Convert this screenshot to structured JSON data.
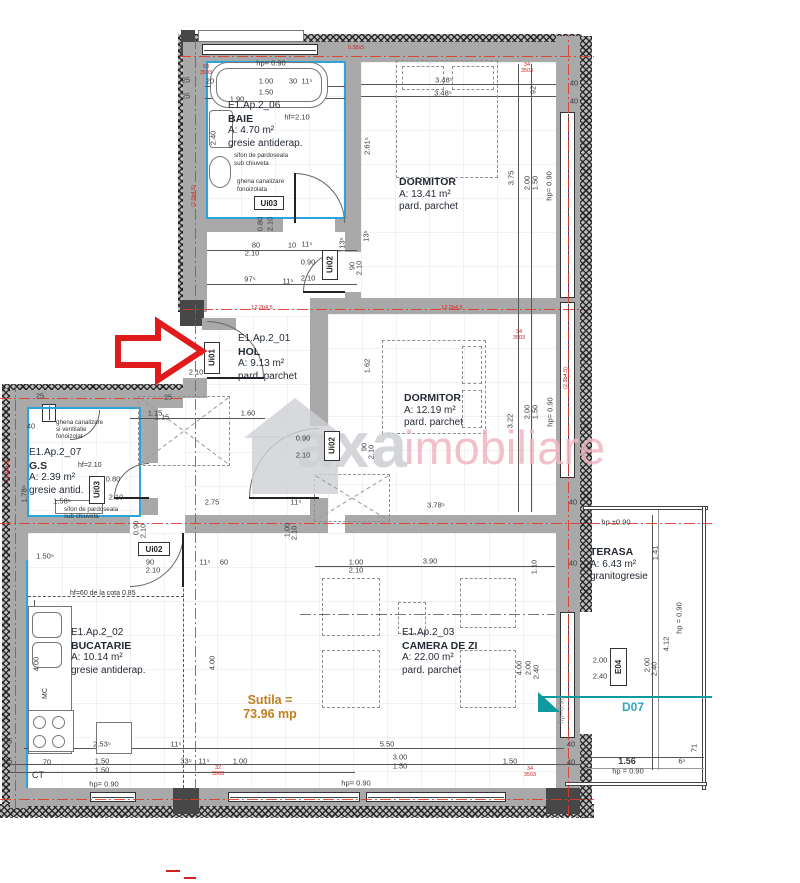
{
  "watermark": {
    "brand_gray": "axa",
    "brand_pink": "imobiliare"
  },
  "colors": {
    "axis_red": "#e03a2a",
    "arrow_red": "#e01b1b",
    "teal": "#0f9aa0",
    "total_orange": "#c07f1f",
    "waterproof_blue": "#2ba3dc",
    "wall_gray": "#a9a9a9"
  },
  "rooms": {
    "baie": {
      "code": "E1.Ap.2_06",
      "name": "BAIE",
      "area": "A: 4.70 m²",
      "floor": "gresie antiderap.",
      "note1": "sifon de pardoseala",
      "note2": "sub chiuveta",
      "note3": "ghena canalizare",
      "note4": "fonoizolata"
    },
    "dormitor1": {
      "name": "DORMITOR",
      "area": "A: 13.41 m²",
      "floor": "pard. parchet"
    },
    "hol": {
      "code": "E1.Ap.2_01",
      "name": "HOL",
      "area": "A: 9.13 m²",
      "floor": "pard. parchet"
    },
    "dormitor2": {
      "name": "DORMITOR",
      "area": "A: 12.19 m²",
      "floor": "pard. parchet"
    },
    "gs": {
      "code": "E1.Ap.2_07",
      "name": "G.S",
      "area": "A: 2.39 m²",
      "floor": "gresie antid.",
      "note1": "ghena canalizare",
      "note2": "si ventilatie",
      "note3": "fonoizolat",
      "note4": "sifon de pardoseala",
      "note5": "sub chiuveta"
    },
    "bucatarie": {
      "code": "E1.Ap.2_02",
      "name": "BUCATARIE",
      "area": "A: 10.14 m²",
      "floor": "gresie antiderap.",
      "note1": "hf=60 de la cota 0.85",
      "mc": "MC",
      "ct": "CT"
    },
    "camera_de_zi": {
      "code": "E1.Ap.2_03",
      "name": "CAMERA DE ZI",
      "area": "A: 22.00 m²",
      "floor": "pard. parchet"
    },
    "terasa": {
      "name": "TERASA",
      "area": "A: 6.43 m²",
      "floor": "granitogresie"
    }
  },
  "total": {
    "label": "Sutila =",
    "value": "73.96 mp"
  },
  "door_labels": {
    "ui01": "Ui01",
    "ui02": "Ui02",
    "ui03": "Ui03",
    "e04": "E04",
    "d07": "D07"
  },
  "dimensions": [
    {
      "t": "hp= 0.90",
      "x": 271,
      "y": 63
    },
    {
      "t": "1.00",
      "x": 266,
      "y": 81
    },
    {
      "t": "1.50",
      "x": 266,
      "y": 92
    },
    {
      "t": "1.90",
      "x": 237,
      "y": 99
    },
    {
      "t": "30",
      "x": 293,
      "y": 81
    },
    {
      "t": "11⁵",
      "x": 307,
      "y": 81
    },
    {
      "t": "20",
      "x": 210,
      "y": 81
    },
    {
      "t": "25",
      "x": 186,
      "y": 80
    },
    {
      "t": "25",
      "x": 186,
      "y": 96
    },
    {
      "t": "2.40",
      "x": 213,
      "y": 138,
      "r": -90
    },
    {
      "t": "hf=2.10",
      "x": 297,
      "y": 117
    },
    {
      "t": "0.80",
      "x": 260,
      "y": 224,
      "r": -90
    },
    {
      "t": "2.10",
      "x": 270,
      "y": 224,
      "r": -90
    },
    {
      "t": "80",
      "x": 256,
      "y": 245
    },
    {
      "t": "10",
      "x": 292,
      "y": 245
    },
    {
      "t": "11⁵",
      "x": 307,
      "y": 244
    },
    {
      "t": "2.10",
      "x": 252,
      "y": 253
    },
    {
      "t": "0.90",
      "x": 308,
      "y": 262
    },
    {
      "t": "2.10",
      "x": 308,
      "y": 278
    },
    {
      "t": "97⁵",
      "x": 250,
      "y": 279
    },
    {
      "t": "11⁵",
      "x": 288,
      "y": 281
    },
    {
      "t": "13⁵",
      "x": 342,
      "y": 243,
      "r": -90
    },
    {
      "t": "90",
      "x": 352,
      "y": 266,
      "r": -90
    },
    {
      "t": "2.10",
      "x": 359,
      "y": 268,
      "r": -90
    },
    {
      "t": "3.48⁵",
      "x": 444,
      "y": 80
    },
    {
      "t": "3.48⁵",
      "x": 443,
      "y": 93
    },
    {
      "t": "92",
      "x": 533,
      "y": 90,
      "r": -90
    },
    {
      "t": "40",
      "x": 574,
      "y": 83
    },
    {
      "t": "40",
      "x": 574,
      "y": 101
    },
    {
      "t": "2.61⁵",
      "x": 367,
      "y": 146,
      "r": -90
    },
    {
      "t": "13⁵",
      "x": 366,
      "y": 236,
      "r": -90
    },
    {
      "t": "3.75",
      "x": 511,
      "y": 178,
      "r": -90
    },
    {
      "t": "2.00",
      "x": 527,
      "y": 183,
      "r": -90
    },
    {
      "t": "1.50",
      "x": 535,
      "y": 183,
      "r": -90
    },
    {
      "t": "hp= 0.90",
      "x": 549,
      "y": 186,
      "r": -90
    },
    {
      "t": "0.90",
      "x": 196,
      "y": 353
    },
    {
      "t": "2.10",
      "x": 196,
      "y": 372
    },
    {
      "t": "1.15",
      "x": 155,
      "y": 413
    },
    {
      "t": "1.60",
      "x": 248,
      "y": 413
    },
    {
      "t": "1.62",
      "x": 367,
      "y": 366,
      "r": -90
    },
    {
      "t": "0.90",
      "x": 303,
      "y": 438
    },
    {
      "t": "2.10",
      "x": 303,
      "y": 455
    },
    {
      "t": "90",
      "x": 364,
      "y": 447,
      "r": -90
    },
    {
      "t": "2.10",
      "x": 371,
      "y": 452,
      "r": -90
    },
    {
      "t": "3.22",
      "x": 510,
      "y": 421,
      "r": -90
    },
    {
      "t": "2.00",
      "x": 527,
      "y": 412,
      "r": -90
    },
    {
      "t": "1.50",
      "x": 535,
      "y": 412,
      "r": -90
    },
    {
      "t": "hp= 0.90",
      "x": 550,
      "y": 412,
      "r": -90
    },
    {
      "t": "3.78⁵",
      "x": 436,
      "y": 505
    },
    {
      "t": "25",
      "x": 40,
      "y": 396
    },
    {
      "t": "25",
      "x": 168,
      "y": 397
    },
    {
      "t": "40",
      "x": 31,
      "y": 426
    },
    {
      "t": "1.15",
      "x": 162,
      "y": 417
    },
    {
      "t": "0.80",
      "x": 113,
      "y": 479
    },
    {
      "t": "2.10",
      "x": 116,
      "y": 497
    },
    {
      "t": "1.58⁵",
      "x": 62,
      "y": 501
    },
    {
      "t": "1.78⁵",
      "x": 24,
      "y": 494,
      "r": -90
    },
    {
      "t": "0.90",
      "x": 136,
      "y": 528,
      "r": -90
    },
    {
      "t": "2.10",
      "x": 143,
      "y": 531,
      "r": -90
    },
    {
      "t": "1.50⁵",
      "x": 45,
      "y": 556
    },
    {
      "t": "2.75",
      "x": 212,
      "y": 502
    },
    {
      "t": "11⁵",
      "x": 296,
      "y": 502
    },
    {
      "t": "90",
      "x": 150,
      "y": 562
    },
    {
      "t": "2.10",
      "x": 153,
      "y": 570
    },
    {
      "t": "11⁵",
      "x": 205,
      "y": 562
    },
    {
      "t": "60",
      "x": 224,
      "y": 562
    },
    {
      "t": "1.00",
      "x": 356,
      "y": 562
    },
    {
      "t": "2.10",
      "x": 356,
      "y": 570
    },
    {
      "t": "1.00",
      "x": 287,
      "y": 530,
      "r": -90
    },
    {
      "t": "2.10",
      "x": 294,
      "y": 533,
      "r": -90
    },
    {
      "t": "3.90",
      "x": 430,
      "y": 561
    },
    {
      "t": "1.10",
      "x": 534,
      "y": 567,
      "r": -90
    },
    {
      "t": "4.00",
      "x": 212,
      "y": 663,
      "r": -90
    },
    {
      "t": "4.00",
      "x": 519,
      "y": 668,
      "r": -90
    },
    {
      "t": "2.00",
      "x": 528,
      "y": 668,
      "r": -90
    },
    {
      "t": "2.40",
      "x": 536,
      "y": 672,
      "r": -90
    },
    {
      "t": "hp=0.90",
      "x": 561,
      "y": 710,
      "r": -90,
      "c": "mut"
    },
    {
      "t": "4.00",
      "x": 36,
      "y": 664,
      "r": -90
    },
    {
      "t": "2.53⁵",
      "x": 102,
      "y": 744
    },
    {
      "t": "11⁵",
      "x": 176,
      "y": 744
    },
    {
      "t": "5.50",
      "x": 387,
      "y": 744
    },
    {
      "t": "25",
      "x": 8,
      "y": 741
    },
    {
      "t": "25",
      "x": 8,
      "y": 761
    },
    {
      "t": "70",
      "x": 47,
      "y": 762
    },
    {
      "t": "1.50",
      "x": 102,
      "y": 761
    },
    {
      "t": "1.50",
      "x": 102,
      "y": 770
    },
    {
      "t": "hp= 0.90",
      "x": 104,
      "y": 784
    },
    {
      "t": "33⁵",
      "x": 186,
      "y": 761
    },
    {
      "t": "11⁵",
      "x": 204,
      "y": 761
    },
    {
      "t": "1.00",
      "x": 240,
      "y": 761
    },
    {
      "t": "3.00",
      "x": 400,
      "y": 757
    },
    {
      "t": "1.50",
      "x": 400,
      "y": 766
    },
    {
      "t": "hp= 0.90",
      "x": 356,
      "y": 783
    },
    {
      "t": "1.50",
      "x": 510,
      "y": 761
    },
    {
      "t": "40",
      "x": 571,
      "y": 744
    },
    {
      "t": "40",
      "x": 571,
      "y": 762
    },
    {
      "t": "hp ±0.90",
      "x": 616,
      "y": 522
    },
    {
      "t": "40",
      "x": 573,
      "y": 502
    },
    {
      "t": "40",
      "x": 573,
      "y": 563
    },
    {
      "t": "1.41",
      "x": 655,
      "y": 553,
      "r": -90
    },
    {
      "t": "hp = 0.90",
      "x": 679,
      "y": 618,
      "r": -90
    },
    {
      "t": "4.12",
      "x": 666,
      "y": 644,
      "r": -90
    },
    {
      "t": "2.00",
      "x": 600,
      "y": 660
    },
    {
      "t": "2.40",
      "x": 600,
      "y": 676
    },
    {
      "t": "2.00",
      "x": 647,
      "y": 665,
      "r": -90
    },
    {
      "t": "2.40",
      "x": 654,
      "y": 669,
      "r": -90
    },
    {
      "t": "1.56",
      "x": 627,
      "y": 761,
      "c": "b"
    },
    {
      "t": "hp = 0.90",
      "x": 628,
      "y": 771
    },
    {
      "t": "6⁵",
      "x": 682,
      "y": 761
    },
    {
      "t": "71",
      "x": 694,
      "y": 748,
      "r": -90
    },
    {
      "t": "34",
      "x": 527,
      "y": 65,
      "c": "red"
    },
    {
      "t": "3503",
      "x": 527,
      "y": 71,
      "c": "red"
    },
    {
      "t": "53",
      "x": 206,
      "y": 67,
      "c": "red"
    },
    {
      "t": "3503",
      "x": 206,
      "y": 73,
      "c": "red"
    },
    {
      "t": "0.38x5",
      "x": 356,
      "y": 48,
      "c": "red"
    },
    {
      "t": "34",
      "x": 519,
      "y": 332,
      "c": "red"
    },
    {
      "t": "3503",
      "x": 519,
      "y": 338,
      "c": "red"
    },
    {
      "t": "12.2b4.5",
      "x": 262,
      "y": 308,
      "c": "red"
    },
    {
      "t": "12.2b4.5",
      "x": 452,
      "y": 308,
      "c": "red"
    },
    {
      "t": "(2.5b4.5)",
      "x": 194,
      "y": 196,
      "r": -90,
      "c": "red"
    },
    {
      "t": "(2.3b4.5)",
      "x": 566,
      "y": 378,
      "r": -90,
      "c": "red"
    },
    {
      "t": "(2.3b4.5)",
      "x": 8,
      "y": 470,
      "r": -90,
      "c": "red"
    },
    {
      "t": "34",
      "x": 530,
      "y": 769,
      "c": "red"
    },
    {
      "t": "3503",
      "x": 530,
      "y": 775,
      "c": "red"
    },
    {
      "t": "32",
      "x": 218,
      "y": 768,
      "c": "red"
    },
    {
      "t": "3503",
      "x": 218,
      "y": 774,
      "c": "red"
    }
  ]
}
